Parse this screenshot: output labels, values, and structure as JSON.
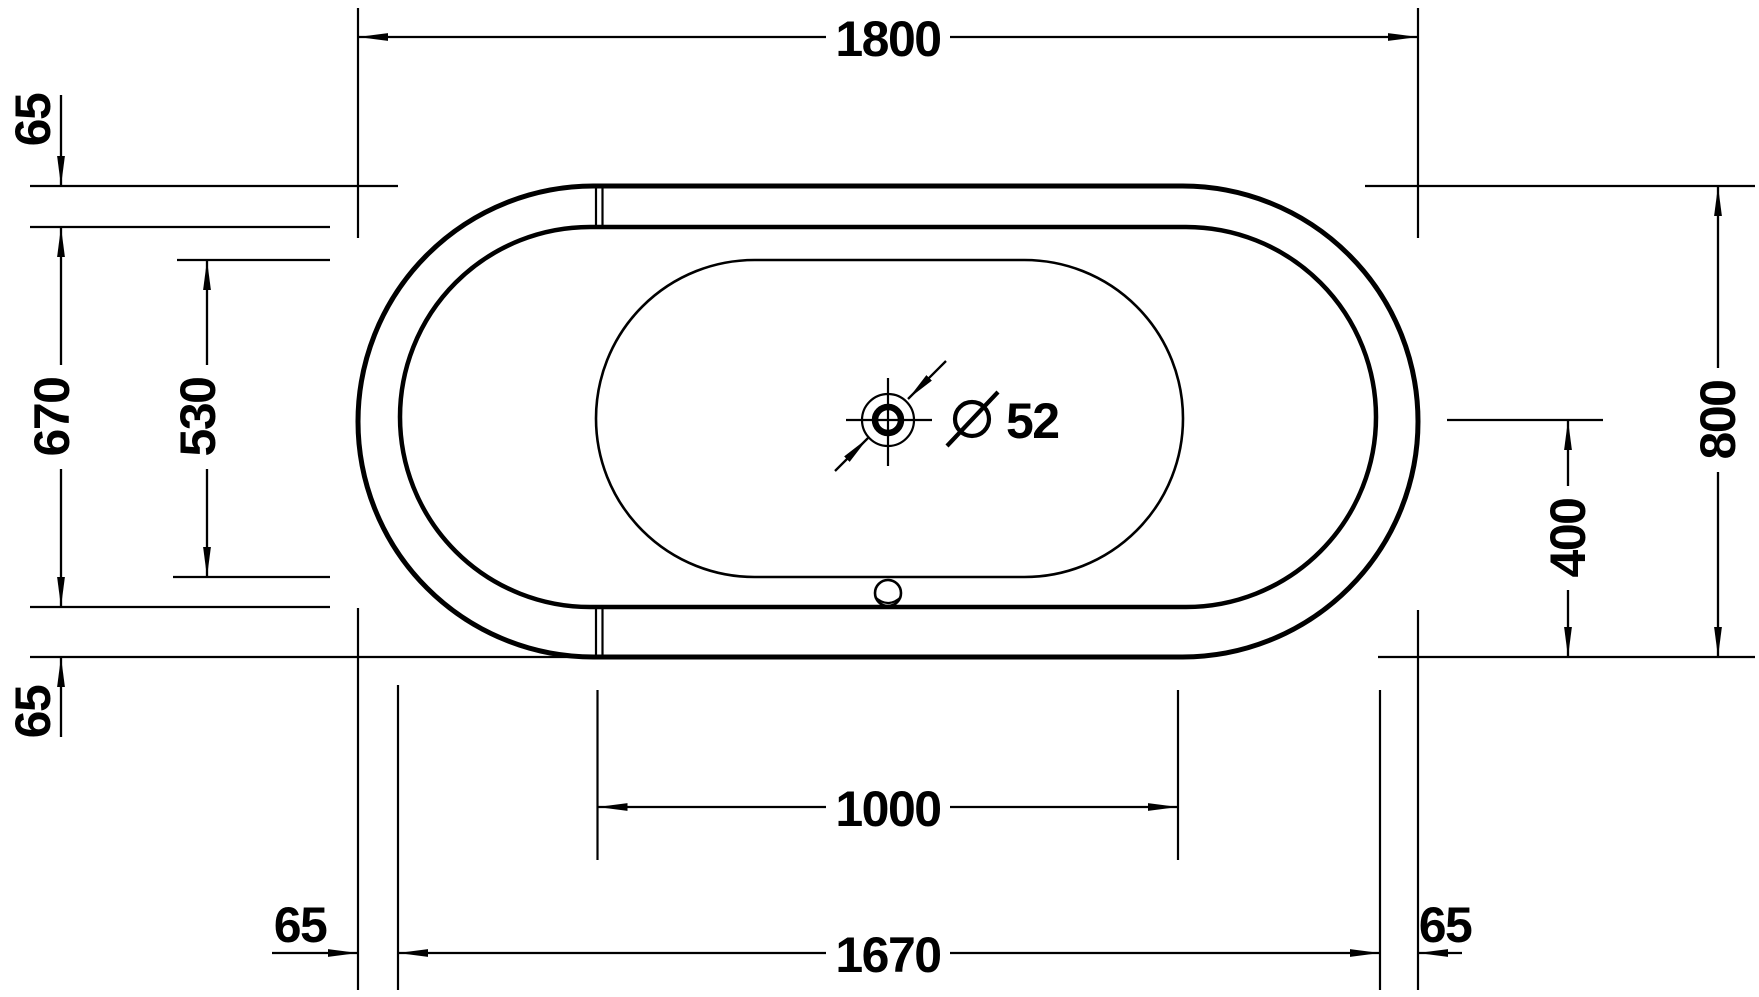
{
  "drawing": {
    "type": "bathtub-plan-technical-drawing",
    "colors": {
      "line": "#000000",
      "background": "#ffffff"
    },
    "labels": {
      "overall_length": "1800",
      "rim_offset_top_left": "65",
      "inner_rim_width": "670",
      "basin_width": "530",
      "rim_offset_bottom_left": "65",
      "overall_width": "800",
      "drain_center_offset": "400",
      "straight_section_length": "1000",
      "foot_clearance_left": "65",
      "foot_length": "1670",
      "foot_clearance_right": "65",
      "drain_diameter_symbol": "Ø",
      "drain_diameter_value": "52"
    }
  }
}
